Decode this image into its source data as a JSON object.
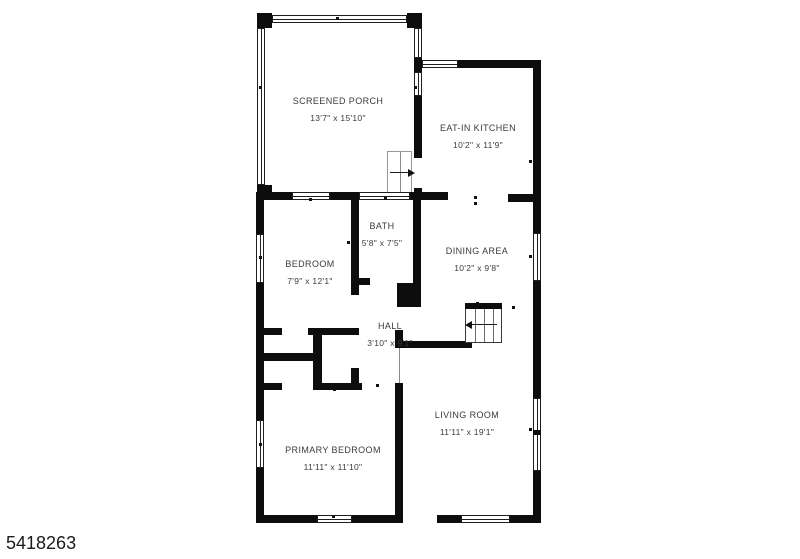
{
  "floorplan": {
    "watermark": "5418263",
    "colors": {
      "wall": "#0d0d0d",
      "text": "#3b3b3b",
      "watermark": "#1a1a1a"
    },
    "rooms": [
      {
        "id": "screened-porch",
        "name": "SCREENED PORCH",
        "dims": "13'7\" x 15'10\""
      },
      {
        "id": "eat-in-kitchen",
        "name": "EAT-IN KITCHEN",
        "dims": "10'2\" x 11'9\""
      },
      {
        "id": "bath",
        "name": "BATH",
        "dims": "5'8\" x 7'5\""
      },
      {
        "id": "dining-area",
        "name": "DINING AREA",
        "dims": "10'2\" x 9'8\""
      },
      {
        "id": "bedroom",
        "name": "BEDROOM",
        "dims": "7'9\" x 12'1\""
      },
      {
        "id": "hall",
        "name": "HALL",
        "dims": "3'10\" x 9'1\""
      },
      {
        "id": "living-room",
        "name": "LIVING ROOM",
        "dims": "11'11\" x 19'1\""
      },
      {
        "id": "primary-bedroom",
        "name": "PRIMARY BEDROOM",
        "dims": "11'11\" x 11'10\""
      }
    ],
    "icons": [
      {
        "name": "stairs-direction-arrow",
        "direction": "left"
      },
      {
        "name": "entry-steps-arrow",
        "direction": "right"
      }
    ]
  }
}
